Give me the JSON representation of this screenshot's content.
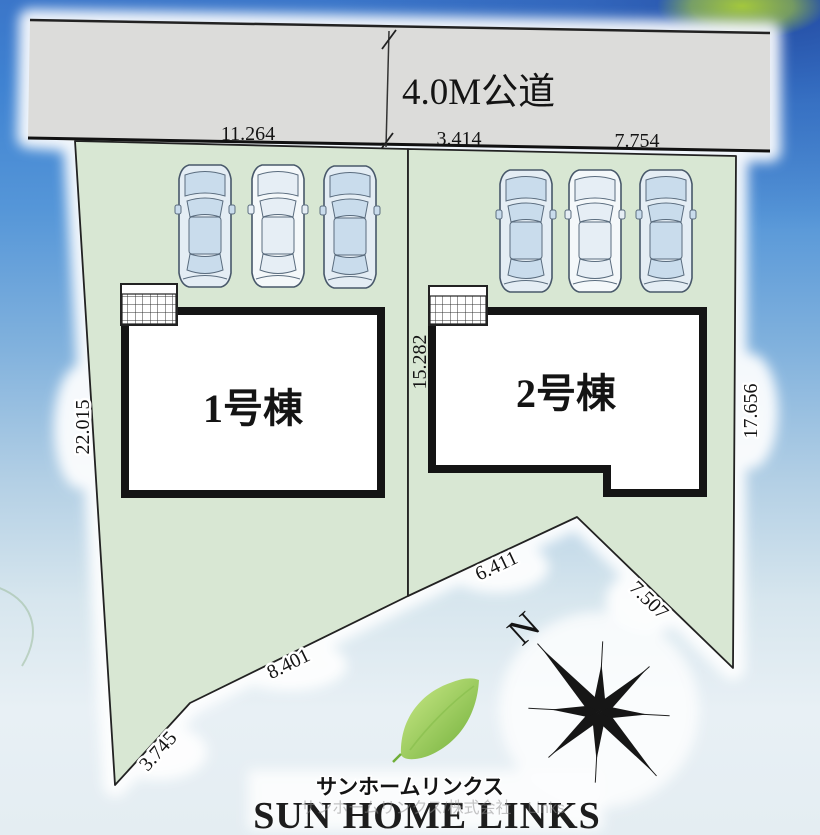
{
  "plan": {
    "road_label": "4.0M公道",
    "buildings": [
      {
        "label": "1号棟"
      },
      {
        "label": "2号棟"
      }
    ],
    "dimensions": {
      "road_front_lot1": "11.264",
      "road_front_lot2_left": "3.414",
      "road_front_lot2_right": "7.754",
      "lot1_left_side": "22.015",
      "center_boundary": "15.282",
      "lot2_right_side": "17.656",
      "lot1_bottom_lower": "3.745",
      "lot1_bottom_upper": "8.401",
      "lot2_bottom_left": "6.411",
      "lot2_bottom_right": "7.507"
    },
    "compass_north_label": "N",
    "parking": {
      "lot1_cars": 3,
      "lot2_cars": 3
    }
  },
  "branding": {
    "katakana_logo": "サンホームリンクス",
    "latin_logo": "SUN HOME LINKS",
    "watermark": "サンホームリンクス/株式会社　Links"
  },
  "colors": {
    "sky_top": "#3b76c9",
    "sky_bottom": "#e4edf2",
    "parcel_fill": "#d8e7d3",
    "road_fill": "#dcdcda",
    "line_black": "#1a1a1a",
    "leaf_green": "#6fae38"
  }
}
